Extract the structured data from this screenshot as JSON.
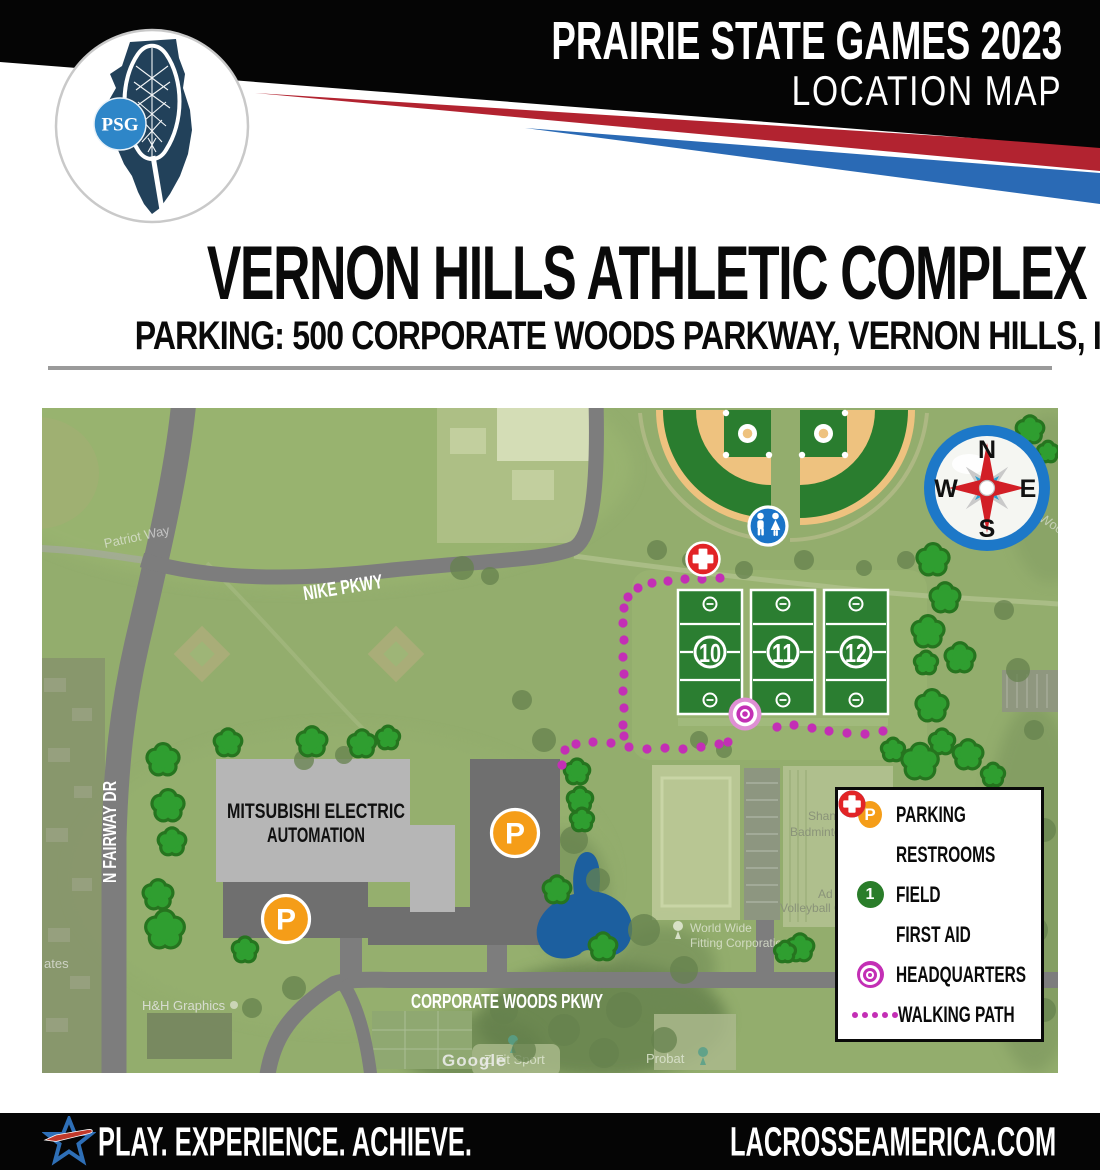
{
  "header": {
    "title": "PRAIRIE STATE GAMES 2023",
    "subtitle": "LOCATION MAP",
    "logo_initials": "PSG"
  },
  "title_block": {
    "title": "VERNON HILLS ATHLETIC COMPLEX",
    "subtitle": "PARKING: 500 CORPORATE WOODS PARKWAY, VERNON HILLS, IL 60061"
  },
  "map": {
    "road_labels": {
      "nike": "NIKE PKWY",
      "fairway": "N FAIRWAY DR",
      "corporate": "CORPORATE WOODS PKWY"
    },
    "building_label_line1": "MITSUBISHI ELECTRIC",
    "building_label_line2": "AUTOMATION",
    "field_numbers": [
      "10",
      "11",
      "12"
    ],
    "compass": {
      "n": "N",
      "e": "E",
      "s": "S",
      "w": "W"
    },
    "icons": {
      "parking_letter": "P",
      "field_badge": "1"
    },
    "watermarks": {
      "google": "Google",
      "patriot": "Patriot Way",
      "estates": "ates",
      "hh": "H&H Graphics",
      "zfit": "Z Fit Sport",
      "probat": "Probat",
      "worldwide1": "World Wide",
      "worldwide2": "Fitting Corporation",
      "badminton1": "Shan",
      "badminton2": "Badminton A",
      "volleyball1": "Ad",
      "volleyball2": "Volleyball C",
      "wood": "Wood"
    },
    "colors": {
      "magenta": "#c32fb5",
      "parking_orange": "#f59d18",
      "restroom_blue": "#1a74c8",
      "field_green": "#2b7e31",
      "firstaid_red": "#e22426",
      "road_gray": "#7d7d7d",
      "pond_blue": "#1c5f9f",
      "tree_green": "#2f9e30",
      "tree_outline": "#26741f",
      "map_base": "#93ad6d"
    },
    "path_dots": [
      [
        678,
        170
      ],
      [
        660,
        171
      ],
      [
        643,
        171
      ],
      [
        626,
        173
      ],
      [
        610,
        175
      ],
      [
        596,
        180
      ],
      [
        586,
        189
      ],
      [
        582,
        200
      ],
      [
        581,
        215
      ],
      [
        582,
        232
      ],
      [
        581,
        249
      ],
      [
        582,
        266
      ],
      [
        581,
        283
      ],
      [
        582,
        300
      ],
      [
        581,
        317
      ],
      [
        582,
        328
      ],
      [
        520,
        357
      ],
      [
        523,
        342
      ],
      [
        534,
        336
      ],
      [
        551,
        334
      ],
      [
        569,
        335
      ],
      [
        587,
        339
      ],
      [
        605,
        341
      ],
      [
        623,
        340
      ],
      [
        641,
        341
      ],
      [
        659,
        339
      ],
      [
        677,
        336
      ],
      [
        686,
        334
      ],
      [
        735,
        319
      ],
      [
        752,
        317
      ],
      [
        770,
        320
      ],
      [
        787,
        323
      ],
      [
        805,
        325
      ],
      [
        823,
        326
      ],
      [
        841,
        323
      ]
    ],
    "trees_bright": [
      [
        121,
        352,
        13
      ],
      [
        186,
        335,
        11
      ],
      [
        126,
        398,
        13
      ],
      [
        130,
        434,
        11
      ],
      [
        116,
        487,
        12
      ],
      [
        123,
        522,
        16
      ],
      [
        203,
        542,
        10
      ],
      [
        270,
        334,
        12
      ],
      [
        320,
        336,
        11
      ],
      [
        346,
        330,
        9
      ],
      [
        535,
        364,
        10
      ],
      [
        538,
        392,
        10
      ],
      [
        540,
        412,
        9
      ],
      [
        515,
        482,
        11
      ],
      [
        561,
        539,
        11
      ],
      [
        891,
        152,
        13
      ],
      [
        903,
        190,
        12
      ],
      [
        886,
        224,
        13
      ],
      [
        884,
        255,
        9
      ],
      [
        918,
        250,
        12
      ],
      [
        890,
        298,
        13
      ],
      [
        900,
        334,
        10
      ],
      [
        878,
        354,
        15
      ],
      [
        926,
        347,
        12
      ],
      [
        951,
        367,
        9
      ],
      [
        988,
        22,
        11
      ],
      [
        1006,
        44,
        8
      ],
      [
        851,
        342,
        9
      ],
      [
        758,
        540,
        11
      ],
      [
        743,
        544,
        8
      ]
    ],
    "trees_muted": [
      [
        420,
        160,
        12
      ],
      [
        448,
        168,
        9
      ],
      [
        615,
        142,
        10
      ],
      [
        648,
        152,
        8
      ],
      [
        702,
        162,
        9
      ],
      [
        762,
        152,
        10
      ],
      [
        822,
        160,
        8
      ],
      [
        864,
        152,
        9
      ],
      [
        480,
        292,
        10
      ],
      [
        502,
        332,
        12
      ],
      [
        532,
        432,
        14
      ],
      [
        556,
        472,
        12
      ],
      [
        602,
        522,
        16
      ],
      [
        642,
        562,
        14
      ],
      [
        582,
        602,
        18
      ],
      [
        522,
        622,
        16
      ],
      [
        462,
        602,
        14
      ],
      [
        482,
        642,
        12
      ],
      [
        562,
        645,
        15
      ],
      [
        622,
        632,
        13
      ],
      [
        962,
        202,
        10
      ],
      [
        976,
        262,
        12
      ],
      [
        992,
        322,
        10
      ],
      [
        1002,
        422,
        12
      ],
      [
        992,
        522,
        14
      ],
      [
        1002,
        602,
        12
      ],
      [
        962,
        622,
        10
      ],
      [
        262,
        352,
        10
      ],
      [
        302,
        347,
        9
      ],
      [
        657,
        332,
        9
      ],
      [
        682,
        342,
        8
      ],
      [
        252,
        580,
        12
      ],
      [
        210,
        600,
        10
      ]
    ]
  },
  "legend": {
    "items": [
      {
        "icon": "parking",
        "label": "PARKING"
      },
      {
        "icon": "restrooms",
        "label": "RESTROOMS"
      },
      {
        "icon": "field",
        "label": "FIELD"
      },
      {
        "icon": "firstaid",
        "label": "FIRST AID"
      },
      {
        "icon": "headquarters",
        "label": "HEADQUARTERS"
      },
      {
        "icon": "path",
        "label": "WALKING PATH"
      }
    ]
  },
  "footer": {
    "tagline": "PLAY. EXPERIENCE. ACHIEVE.",
    "website": "LACROSSEAMERICA.COM"
  }
}
